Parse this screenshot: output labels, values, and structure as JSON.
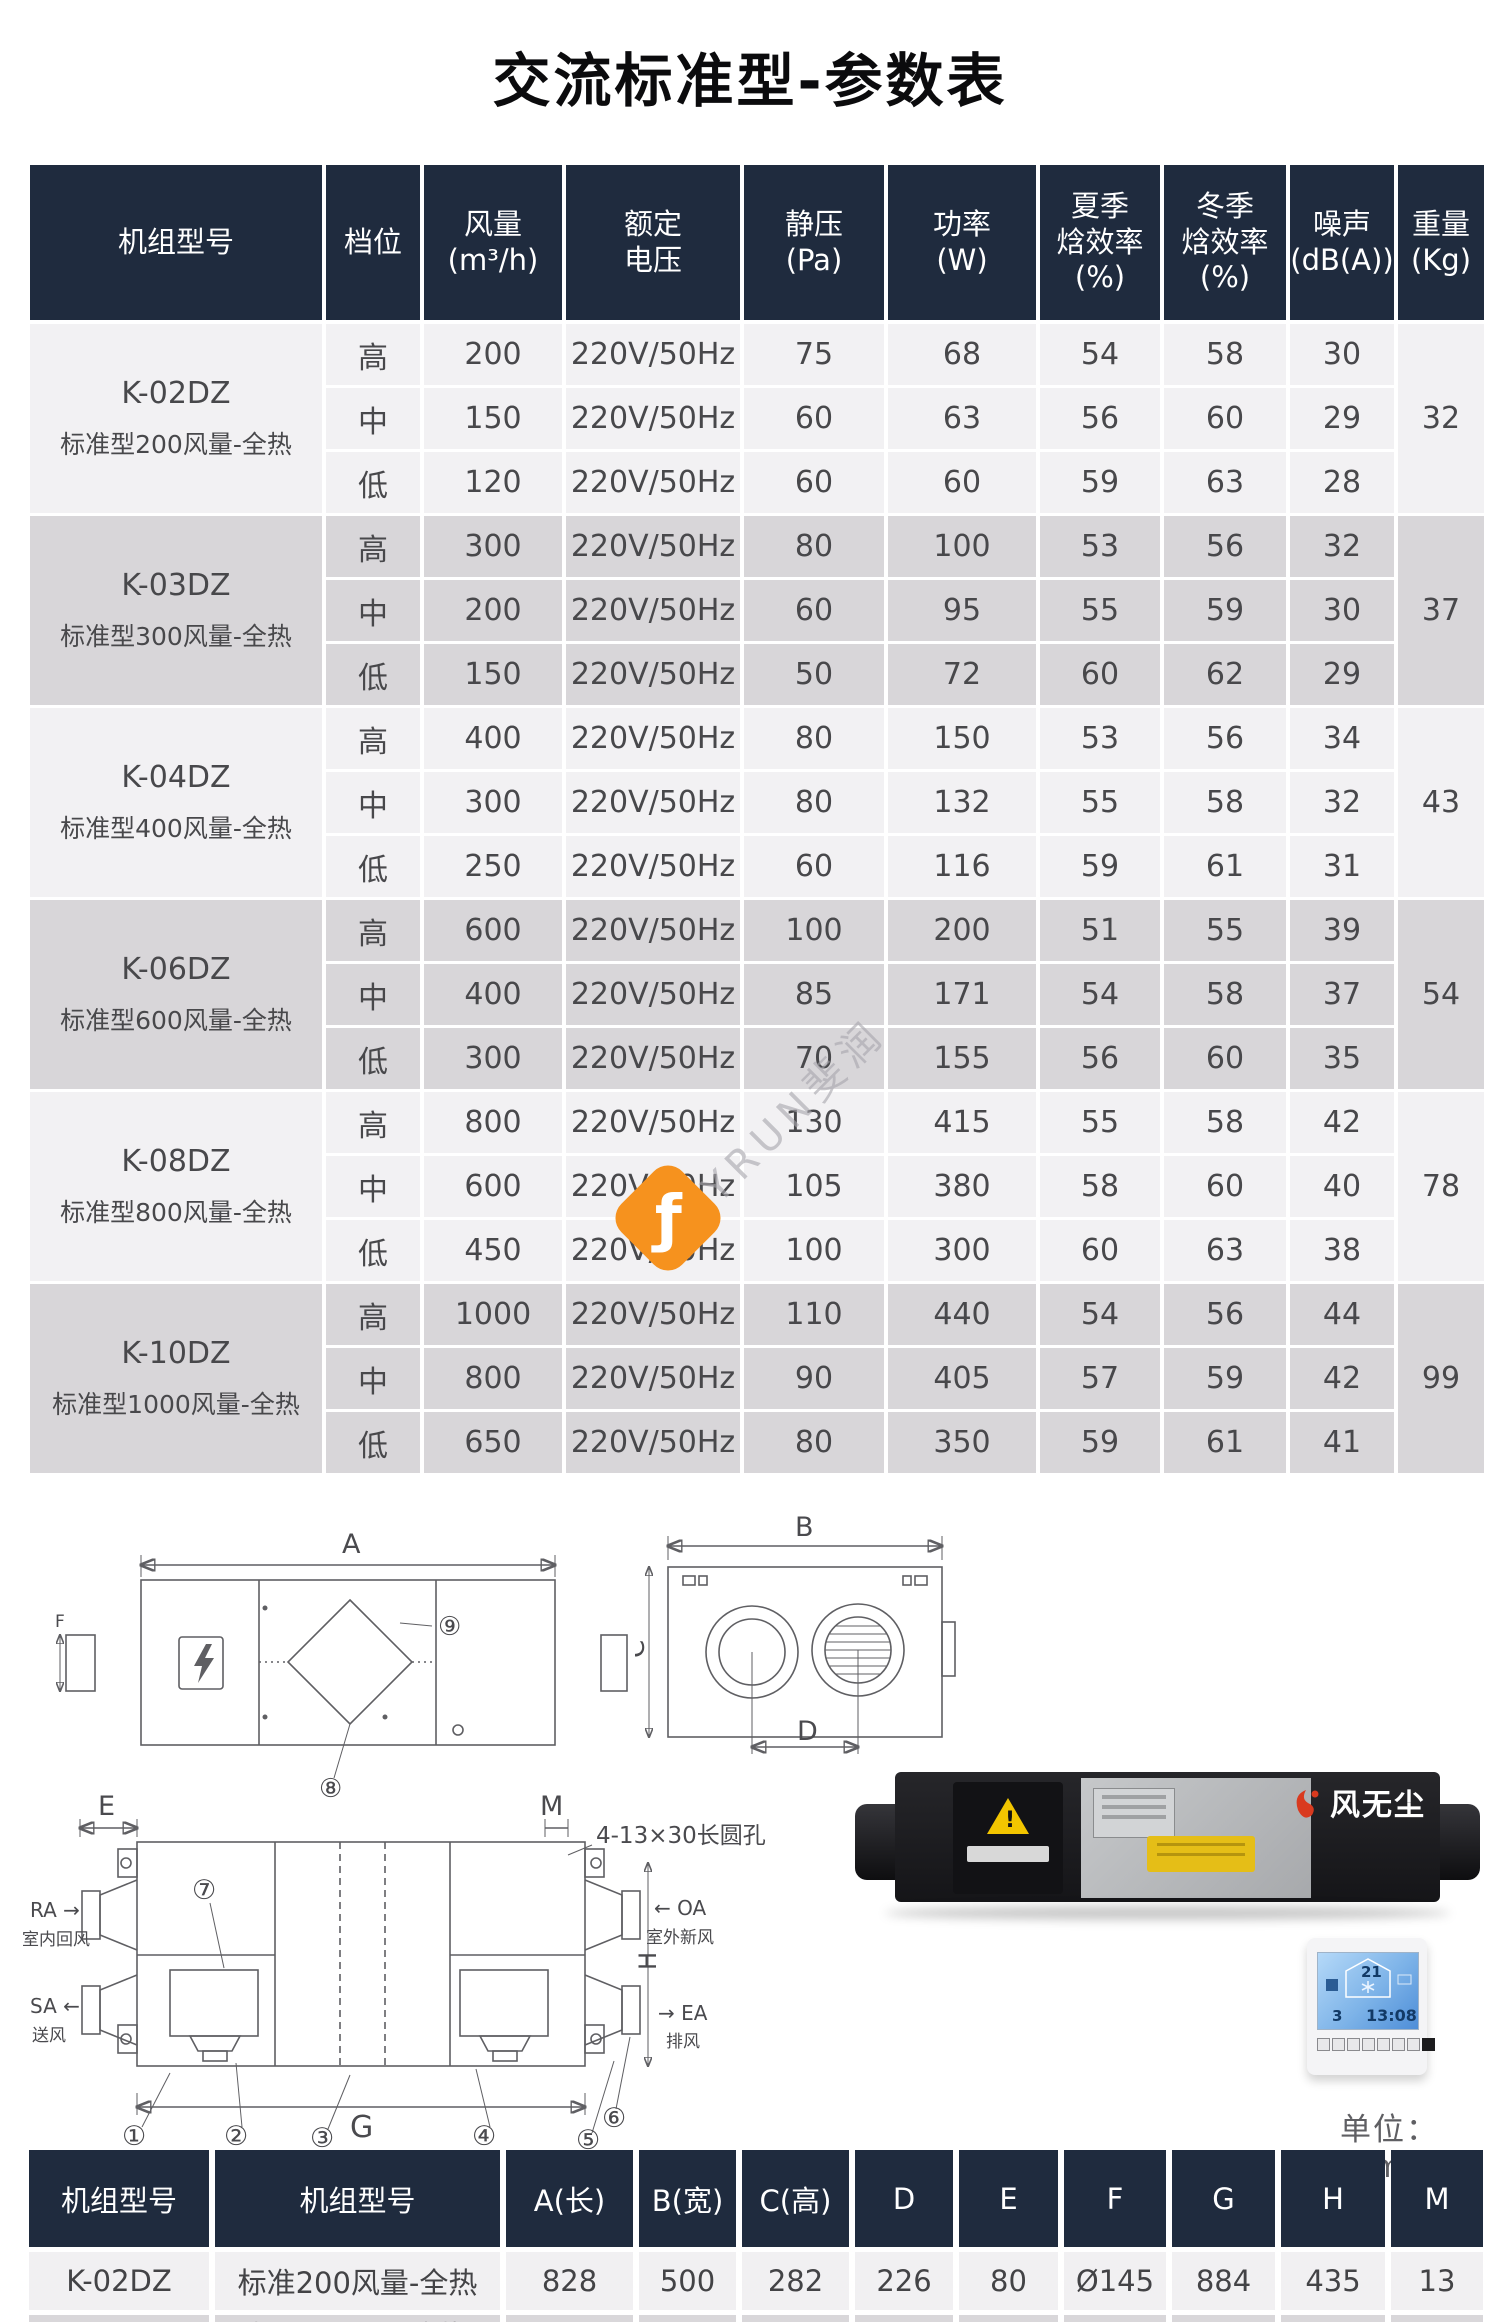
{
  "title": "交流标准型-参数表",
  "colors": {
    "header_bg": "#1f2b3e",
    "row_light": "#f2f1f3",
    "row_shade": "#d8d6d9",
    "watermark_orange": "#f6921e"
  },
  "watermark": {
    "text": "FLYRUN斐润",
    "logo_glyph": "ƒ"
  },
  "main_table": {
    "headers": [
      "机组型号",
      "档位",
      "风量\n(m³/h)",
      "额定\n电压",
      "静压\n(Pa)",
      "功率\n(W)",
      "夏季\n焓效率\n(%)",
      "冬季\n焓效率\n(%)",
      "噪声\n(dB(A))",
      "重量\n(Kg)"
    ],
    "models": [
      {
        "model": "K-02DZ",
        "desc": "标准型200风量-全热",
        "weight": "32",
        "rows": [
          {
            "gear": "高",
            "airflow": "200",
            "voltage": "220V/50Hz",
            "pressure": "75",
            "power": "68",
            "summer": "54",
            "winter": "58",
            "noise": "30"
          },
          {
            "gear": "中",
            "airflow": "150",
            "voltage": "220V/50Hz",
            "pressure": "60",
            "power": "63",
            "summer": "56",
            "winter": "60",
            "noise": "29"
          },
          {
            "gear": "低",
            "airflow": "120",
            "voltage": "220V/50Hz",
            "pressure": "60",
            "power": "60",
            "summer": "59",
            "winter": "63",
            "noise": "28"
          }
        ]
      },
      {
        "model": "K-03DZ",
        "desc": "标准型300风量-全热",
        "weight": "37",
        "rows": [
          {
            "gear": "高",
            "airflow": "300",
            "voltage": "220V/50Hz",
            "pressure": "80",
            "power": "100",
            "summer": "53",
            "winter": "56",
            "noise": "32"
          },
          {
            "gear": "中",
            "airflow": "200",
            "voltage": "220V/50Hz",
            "pressure": "60",
            "power": "95",
            "summer": "55",
            "winter": "59",
            "noise": "30"
          },
          {
            "gear": "低",
            "airflow": "150",
            "voltage": "220V/50Hz",
            "pressure": "50",
            "power": "72",
            "summer": "60",
            "winter": "62",
            "noise": "29"
          }
        ]
      },
      {
        "model": "K-04DZ",
        "desc": "标准型400风量-全热",
        "weight": "43",
        "rows": [
          {
            "gear": "高",
            "airflow": "400",
            "voltage": "220V/50Hz",
            "pressure": "80",
            "power": "150",
            "summer": "53",
            "winter": "56",
            "noise": "34"
          },
          {
            "gear": "中",
            "airflow": "300",
            "voltage": "220V/50Hz",
            "pressure": "80",
            "power": "132",
            "summer": "55",
            "winter": "58",
            "noise": "32"
          },
          {
            "gear": "低",
            "airflow": "250",
            "voltage": "220V/50Hz",
            "pressure": "60",
            "power": "116",
            "summer": "59",
            "winter": "61",
            "noise": "31"
          }
        ]
      },
      {
        "model": "K-06DZ",
        "desc": "标准型600风量-全热",
        "weight": "54",
        "rows": [
          {
            "gear": "高",
            "airflow": "600",
            "voltage": "220V/50Hz",
            "pressure": "100",
            "power": "200",
            "summer": "51",
            "winter": "55",
            "noise": "39"
          },
          {
            "gear": "中",
            "airflow": "400",
            "voltage": "220V/50Hz",
            "pressure": "85",
            "power": "171",
            "summer": "54",
            "winter": "58",
            "noise": "37"
          },
          {
            "gear": "低",
            "airflow": "300",
            "voltage": "220V/50Hz",
            "pressure": "70",
            "power": "155",
            "summer": "56",
            "winter": "60",
            "noise": "35"
          }
        ]
      },
      {
        "model": "K-08DZ",
        "desc": "标准型800风量-全热",
        "weight": "78",
        "rows": [
          {
            "gear": "高",
            "airflow": "800",
            "voltage": "220V/50Hz",
            "pressure": "130",
            "power": "415",
            "summer": "55",
            "winter": "58",
            "noise": "42"
          },
          {
            "gear": "中",
            "airflow": "600",
            "voltage": "220V/50Hz",
            "pressure": "105",
            "power": "380",
            "summer": "58",
            "winter": "60",
            "noise": "40"
          },
          {
            "gear": "低",
            "airflow": "450",
            "voltage": "220V/50Hz",
            "pressure": "100",
            "power": "300",
            "summer": "60",
            "winter": "63",
            "noise": "38"
          }
        ]
      },
      {
        "model": "K-10DZ",
        "desc": "标准型1000风量-全热",
        "weight": "99",
        "rows": [
          {
            "gear": "高",
            "airflow": "1000",
            "voltage": "220V/50Hz",
            "pressure": "110",
            "power": "440",
            "summer": "54",
            "winter": "56",
            "noise": "44"
          },
          {
            "gear": "中",
            "airflow": "800",
            "voltage": "220V/50Hz",
            "pressure": "90",
            "power": "405",
            "summer": "57",
            "winter": "59",
            "noise": "42"
          },
          {
            "gear": "低",
            "airflow": "650",
            "voltage": "220V/50Hz",
            "pressure": "80",
            "power": "350",
            "summer": "59",
            "winter": "61",
            "noise": "41"
          }
        ]
      }
    ]
  },
  "drawings": {
    "d1": {
      "a": "A",
      "f": "F",
      "c8": "⑧",
      "c9": "⑨"
    },
    "d2": {
      "b": "B",
      "c": "C",
      "d": "D"
    },
    "d3": {
      "e": "E",
      "m": "M",
      "g": "G",
      "h": "H",
      "hole_note": "4-13×30长圆孔",
      "ra_label": "RA →",
      "ra_desc": "室内回风",
      "sa_label": "SA ←",
      "sa_desc": "送风",
      "oa_label": "← OA",
      "oa_desc": "室外新风",
      "ea_label": "→ EA",
      "ea_desc": "排风",
      "c1": "①",
      "c2": "②",
      "c3": "③",
      "c4": "④",
      "c5": "⑤",
      "c6": "⑥",
      "c7": "⑦"
    }
  },
  "photo": {
    "brand": "风无尘",
    "warning_mark": "!"
  },
  "thermostat": {
    "temp": "21",
    "day": "3",
    "time": "13:08"
  },
  "unit_note": "单位：mm",
  "dim_table": {
    "headers": [
      "机组型号",
      "机组型号",
      "A(长)",
      "B(宽)",
      "C(高)",
      "D",
      "E",
      "F",
      "G",
      "H",
      "M"
    ],
    "rows": [
      [
        "K-02DZ",
        "标准200风量-全热",
        "828",
        "500",
        "282",
        "226",
        "80",
        "Ø145",
        "884",
        "435",
        "13"
      ]
    ],
    "partial_row": [
      "",
      "标准300风量-全热",
      "",
      "",
      "",
      "",
      "",
      "",
      "",
      "",
      ""
    ]
  }
}
